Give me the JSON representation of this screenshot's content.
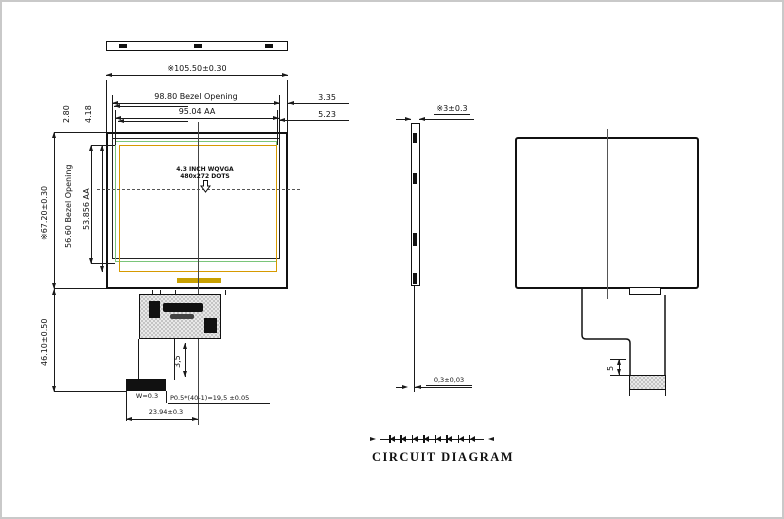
{
  "front": {
    "ref_mark": "※",
    "dim_width_total": "105.50±0.30",
    "dim_bezel_w": "98.80 Bezel Opening",
    "dim_aa_w": "95.04 AA",
    "dim_right_1": "3.35",
    "dim_right_2": "5.23",
    "dim_top_left_1": "2.80",
    "dim_top_left_2": "4.18",
    "dim_height_total": "67.20±0.30",
    "dim_bezel_h": "56.60 Bezel Opening",
    "dim_aa_h": "53.856 AA",
    "dim_fpc_len": "46.10±0.50",
    "screen_label_1": "4.3 INCH WQVGA",
    "screen_label_2": "480x272 DOTS",
    "dim_neck": "3,5",
    "dim_contact": "W=0.3",
    "dim_pitch": "P0.5*(40-1)=19,5 ±0.05",
    "dim_fpc_w": "23.94±0.3"
  },
  "side": {
    "dim_thickness": "3±0.3",
    "dim_fpc_thickness": "0,3±0,03"
  },
  "rear": {
    "dim_contact_len": "5"
  },
  "circuit": {
    "title": "CIRCUIT DIAGRAM",
    "led_count": 8
  },
  "colors": {
    "line": "#1a1a1a",
    "bezel_green": "#7ac57a",
    "aa_amber": "#d69a00",
    "gold_bar": "#c8a000"
  }
}
